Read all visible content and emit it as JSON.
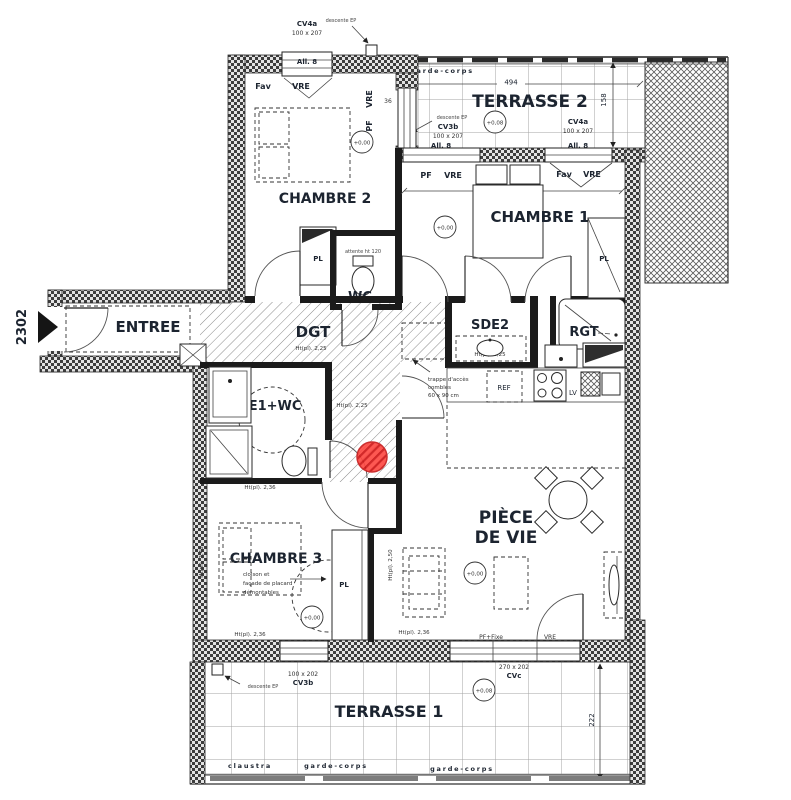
{
  "plan": {
    "unit": "2302",
    "marker_color": "#c81e1e"
  },
  "rooms": {
    "chambre1": {
      "name": "CHAMBRE 1",
      "elevation": "+0,00",
      "width_dim": "458"
    },
    "chambre2": {
      "name": "CHAMBRE 2",
      "elevation": "+0,00"
    },
    "chambre3": {
      "name": "CHAMBRE 3",
      "elevation": "+0,00",
      "note_line1": "cloison et",
      "note_line2": "façade de placard",
      "note_line3": "démontables",
      "height_top": "Ht(pl).  2,36",
      "height_bottom": "Ht(pl).  2,36",
      "height_left": "Ht(pl).  2,48",
      "height_right": "Ht(pl).  2,50"
    },
    "entree": {
      "name": "ENTREE"
    },
    "dgt": {
      "name": "DGT",
      "height": "Ht(pl).  2,25"
    },
    "wc": {
      "name": "WC",
      "note": "attente ht 120"
    },
    "sde1": {
      "name": "SDE1+WC",
      "height": "Ht(pl).  2,25"
    },
    "sde2": {
      "name": "SDE2",
      "height": "Ht(pl).  2,25"
    },
    "rgt": {
      "name": "RGT"
    },
    "piece_de_vie": {
      "name_line1": "PIÈCE",
      "name_line2": "DE VIE",
      "elevation": "+0,00",
      "height": "Ht(pl).  2,36"
    },
    "terrasse1": {
      "name": "TERRASSE 1",
      "elevation": "+0,08",
      "depth_dim": "222"
    },
    "terrasse2": {
      "name": "TERRASSE 2",
      "elevation": "+0,08",
      "width_dim": "494",
      "depth_dim": "158"
    }
  },
  "openings": {
    "cv4a": "CV4a",
    "cv3b": "CV3b",
    "cvc": "CVc",
    "allege8": "All. 8",
    "size_100x207": "100 x 207",
    "size_100x202": "100 x 202",
    "size_270x202": "270 x 202",
    "pf": "PF",
    "vre": "VRE",
    "fav": "Fav",
    "pf_fixe": "PF+Fixe",
    "dim_36": "36"
  },
  "annotations": {
    "descente_ep": "descente EP",
    "garde_corps": "garde-corps",
    "claustra": "claustra",
    "trappe_line1": "trappe d'accès",
    "trappe_line2": "combles",
    "trappe_line3": "60 x 90 cm",
    "ref": "REF",
    "lv": "LV",
    "pl": "PL"
  }
}
